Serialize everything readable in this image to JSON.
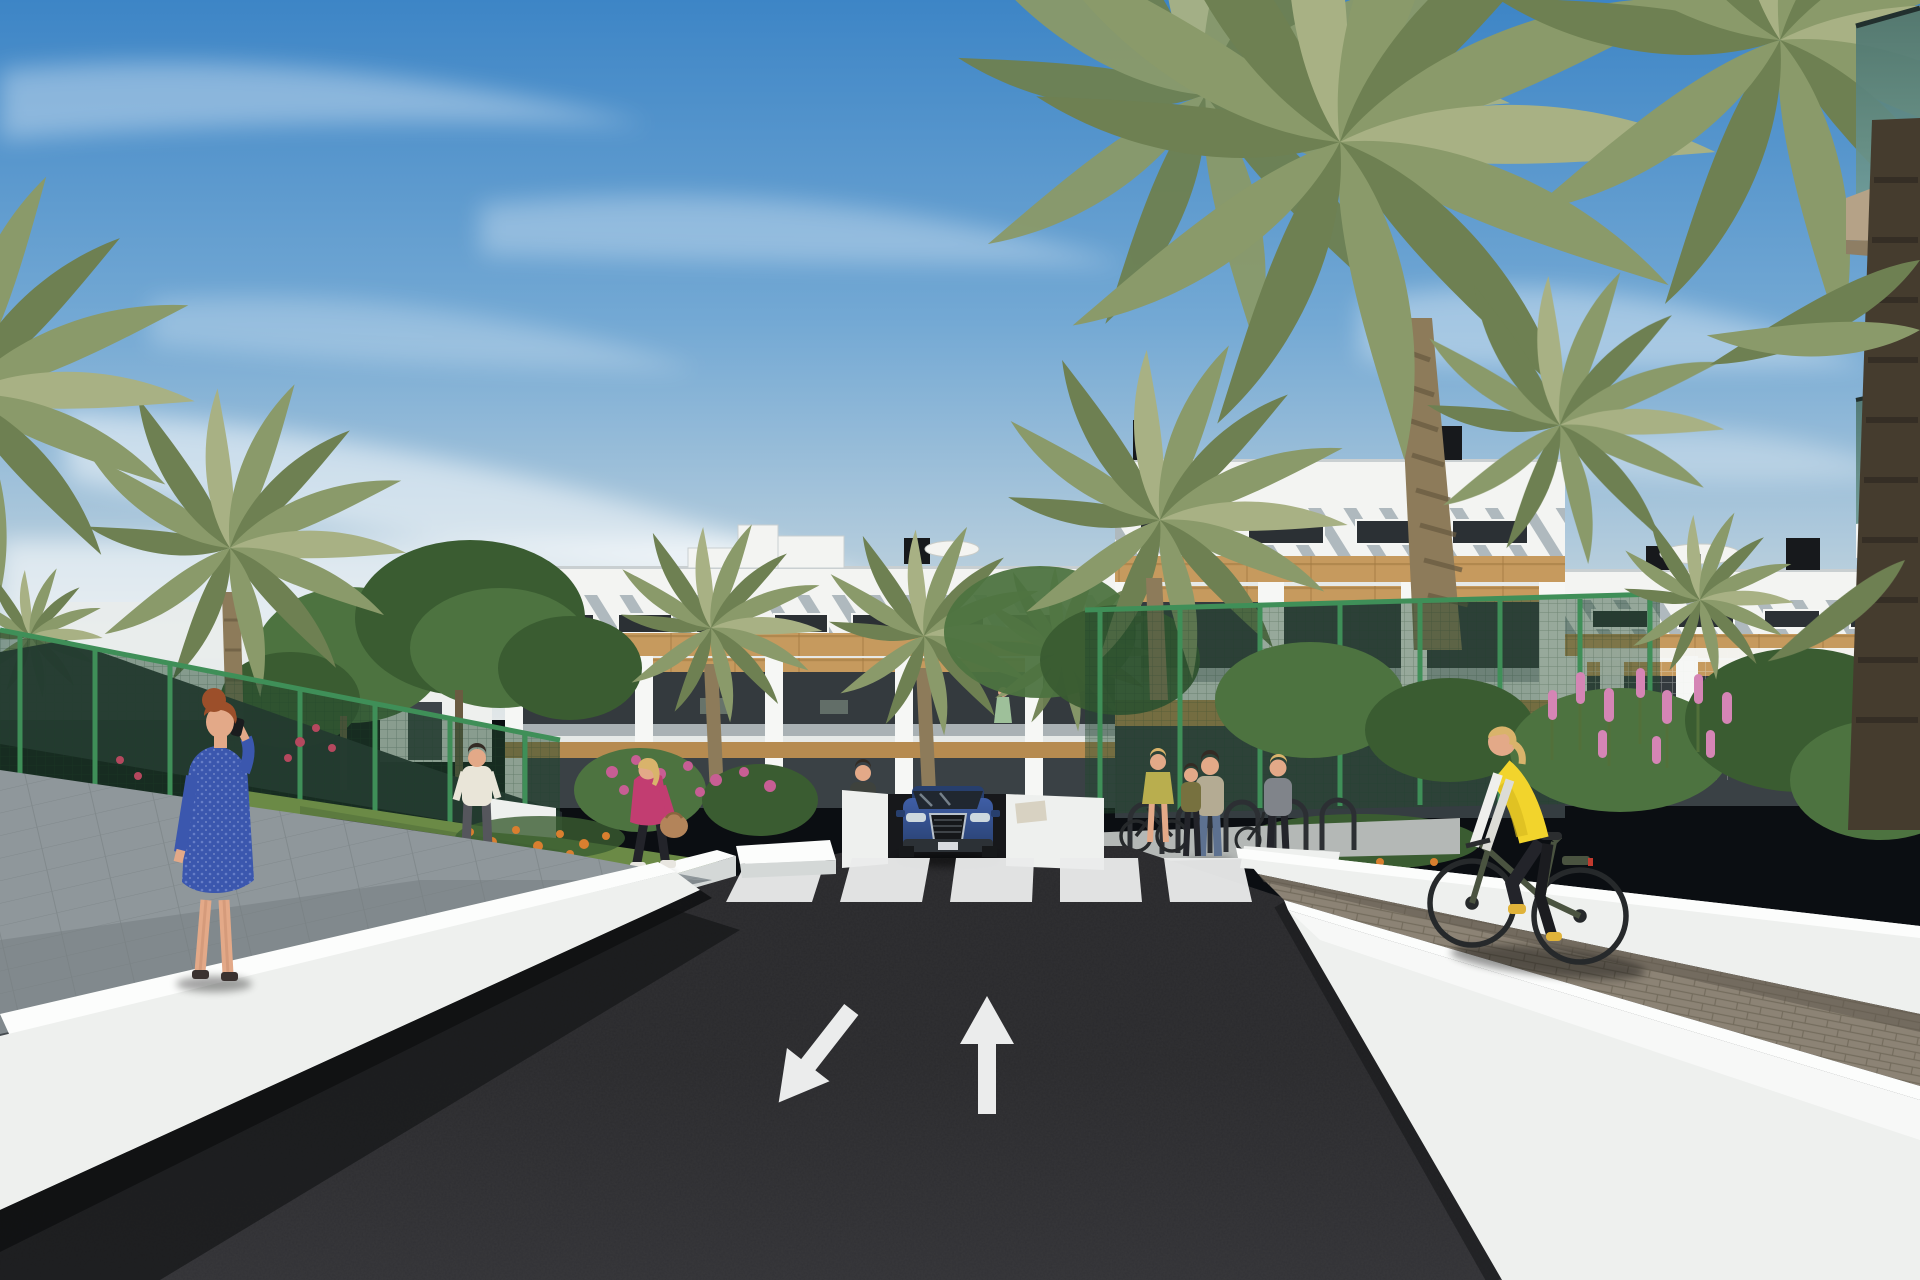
{
  "scene": {
    "title": "3D architectural rendering: modern white apartment complex with palm-lined entrance road, crosswalk, pedestrians and a cyclist on a sunny day",
    "setting": "sunny daytime, blue sky with thin cirrus clouds",
    "objects": [
      {
        "name": "apartment-building",
        "description": "three-storey white residential block with diagonal louvre parapet, dark glazing, timber band and pergola balconies"
      },
      {
        "name": "rooftop-units",
        "description": "black AC/chimney boxes and white parasols on the roof terraces"
      },
      {
        "name": "palm-trees",
        "description": "tall date palms on the right, medium palms along the facade and left garden"
      },
      {
        "name": "shade-canopy",
        "description": "dark shade sail over the left garden court"
      },
      {
        "name": "green-fence",
        "description": "green mesh boundary fence on both sides"
      },
      {
        "name": "road",
        "description": "dark asphalt entrance road with zebra crossing, lane arrows and garage ramp"
      },
      {
        "name": "car",
        "description": "blue SUV facing the viewer at the garage ramp"
      },
      {
        "name": "retaining-walls",
        "description": "white wedge-shaped retaining walls flanking the road"
      },
      {
        "name": "paver-path",
        "description": "brick paver sidewalk on the right where the cyclist rides"
      },
      {
        "name": "left-walkway",
        "description": "grey paved walkway on the left"
      }
    ],
    "people": [
      {
        "name": "woman-blue-dress",
        "description": "red-haired woman in a blue patterned dress on the phone, left walkway"
      },
      {
        "name": "man-white-shirt",
        "description": "man in light shirt and dark trousers walking along the left fence"
      },
      {
        "name": "woman-pink-jacket",
        "description": "blonde woman in magenta jacket carrying a tan handbag"
      },
      {
        "name": "woman-by-ramp",
        "description": "woman standing beside the garage ramp near the crosswalk"
      },
      {
        "name": "woman-with-bike",
        "description": "woman in chartreuse top at the bike racks"
      },
      {
        "name": "mother-and-child",
        "description": "mother with child standing near the bike racks"
      },
      {
        "name": "woman-pushing-bike",
        "description": "woman in grey coat wheeling a bike on the right"
      },
      {
        "name": "cyclist-yellow-vest",
        "description": "blonde woman in yellow gilet riding a dark green bicycle on the paver path"
      },
      {
        "name": "balcony-residents",
        "description": "small figures on the first-floor balconies"
      }
    ],
    "road_markings": {
      "crosswalk_stripes": 5,
      "arrows": [
        "straight-ahead",
        "oncoming-down-left"
      ]
    }
  },
  "colors": {
    "sky_top": "#3d85c6",
    "sky_mid": "#74a9d4",
    "sky_low": "#b9cfdd",
    "horizon_haze": "#e2e7e8",
    "cloud": "#ffffff",
    "building_white": "#f3f4f2",
    "building_tint": "#e6e9e7",
    "parapet_shadow": "#c9cfd1",
    "slat_gray": "#93a0a8",
    "window_dark": "#2b3034",
    "window_frame": "#f5f6f4",
    "wood": "#c69a5e",
    "wood_dark": "#a07942",
    "wood_soffit": "#b68b50",
    "pier_white": "#f6f7f5",
    "pier_shade": "#d9dedd",
    "balcony_dark": "#343a3e",
    "rail_glass": "#77848a",
    "fence_green": "#2f6b45",
    "fence_post": "#3f8f58",
    "fence_dark": "#24492f",
    "palm_green": "#8a9a6a",
    "palm_dark": "#6e8052",
    "palm_pale": "#a8b184",
    "tree_green": "#4d7340",
    "tree_dark": "#3a5c31",
    "trunk": "#8d7b5a",
    "trunk_dark": "#6a5b41",
    "trunk_fore": "#453c2e",
    "grass": "#6b8a46",
    "grass_dark": "#52703a",
    "canopy_dark": "#242b30",
    "asphalt": "#2a2a2d",
    "asphalt_light": "#323236",
    "asphalt_shadow": "#17181a",
    "path_asphalt": "#45484c",
    "mark_white": "#ebecec",
    "wall_white": "#eef0ee",
    "wall_cap": "#fcfdfc",
    "wall_shade": "#d4d8d7",
    "walkway_gray": "#8f979b",
    "walkway_light": "#c3c8c9",
    "plaza_gray": "#b4b8b6",
    "paver": "#8c8375",
    "paver_dark": "#6e6658",
    "garage_dark": "#17181b",
    "car_blue": "#3f5ea6",
    "car_blue_dark": "#273f6e",
    "car_glass": "#202730",
    "car_trim": "#15171a",
    "car_silver": "#b9c2cc",
    "skin": "#e3a988",
    "hair_red": "#9c4f2a",
    "hair_blonde": "#d9b36b",
    "hair_dark": "#332b24",
    "dress_blue": "#3b57ae",
    "dress_dot": "#8fa3e0",
    "shirt_white": "#e9e5d8",
    "pants_gray": "#55565c",
    "jacket_pink": "#c23d71",
    "bag_tan": "#b3845a",
    "pants_black": "#23242a",
    "vest_yellow": "#f2d42c",
    "sleeve_white": "#efefec",
    "shoe_yellow": "#e0b33a",
    "bike_olive": "#4a5340",
    "wheel_dark": "#26292b",
    "top_chartreuse": "#b9ae4e",
    "jeans_blue": "#5d7190",
    "floral_top": "#b4ab93",
    "child_olive": "#77713f",
    "coat_gray": "#80848a",
    "flower_pink": "#d585b5",
    "flower_magenta": "#c75e94",
    "flower_orange": "#d97f2f",
    "flower_red": "#b5485e",
    "glass_teal": "#6f9a93",
    "glass_teal_dark": "#4c736d",
    "soffit_tan": "#b5a287",
    "soffit_dark": "#8e7e64",
    "umbrella_white": "#f4f4f1",
    "rooftop_dark": "#17191c"
  }
}
